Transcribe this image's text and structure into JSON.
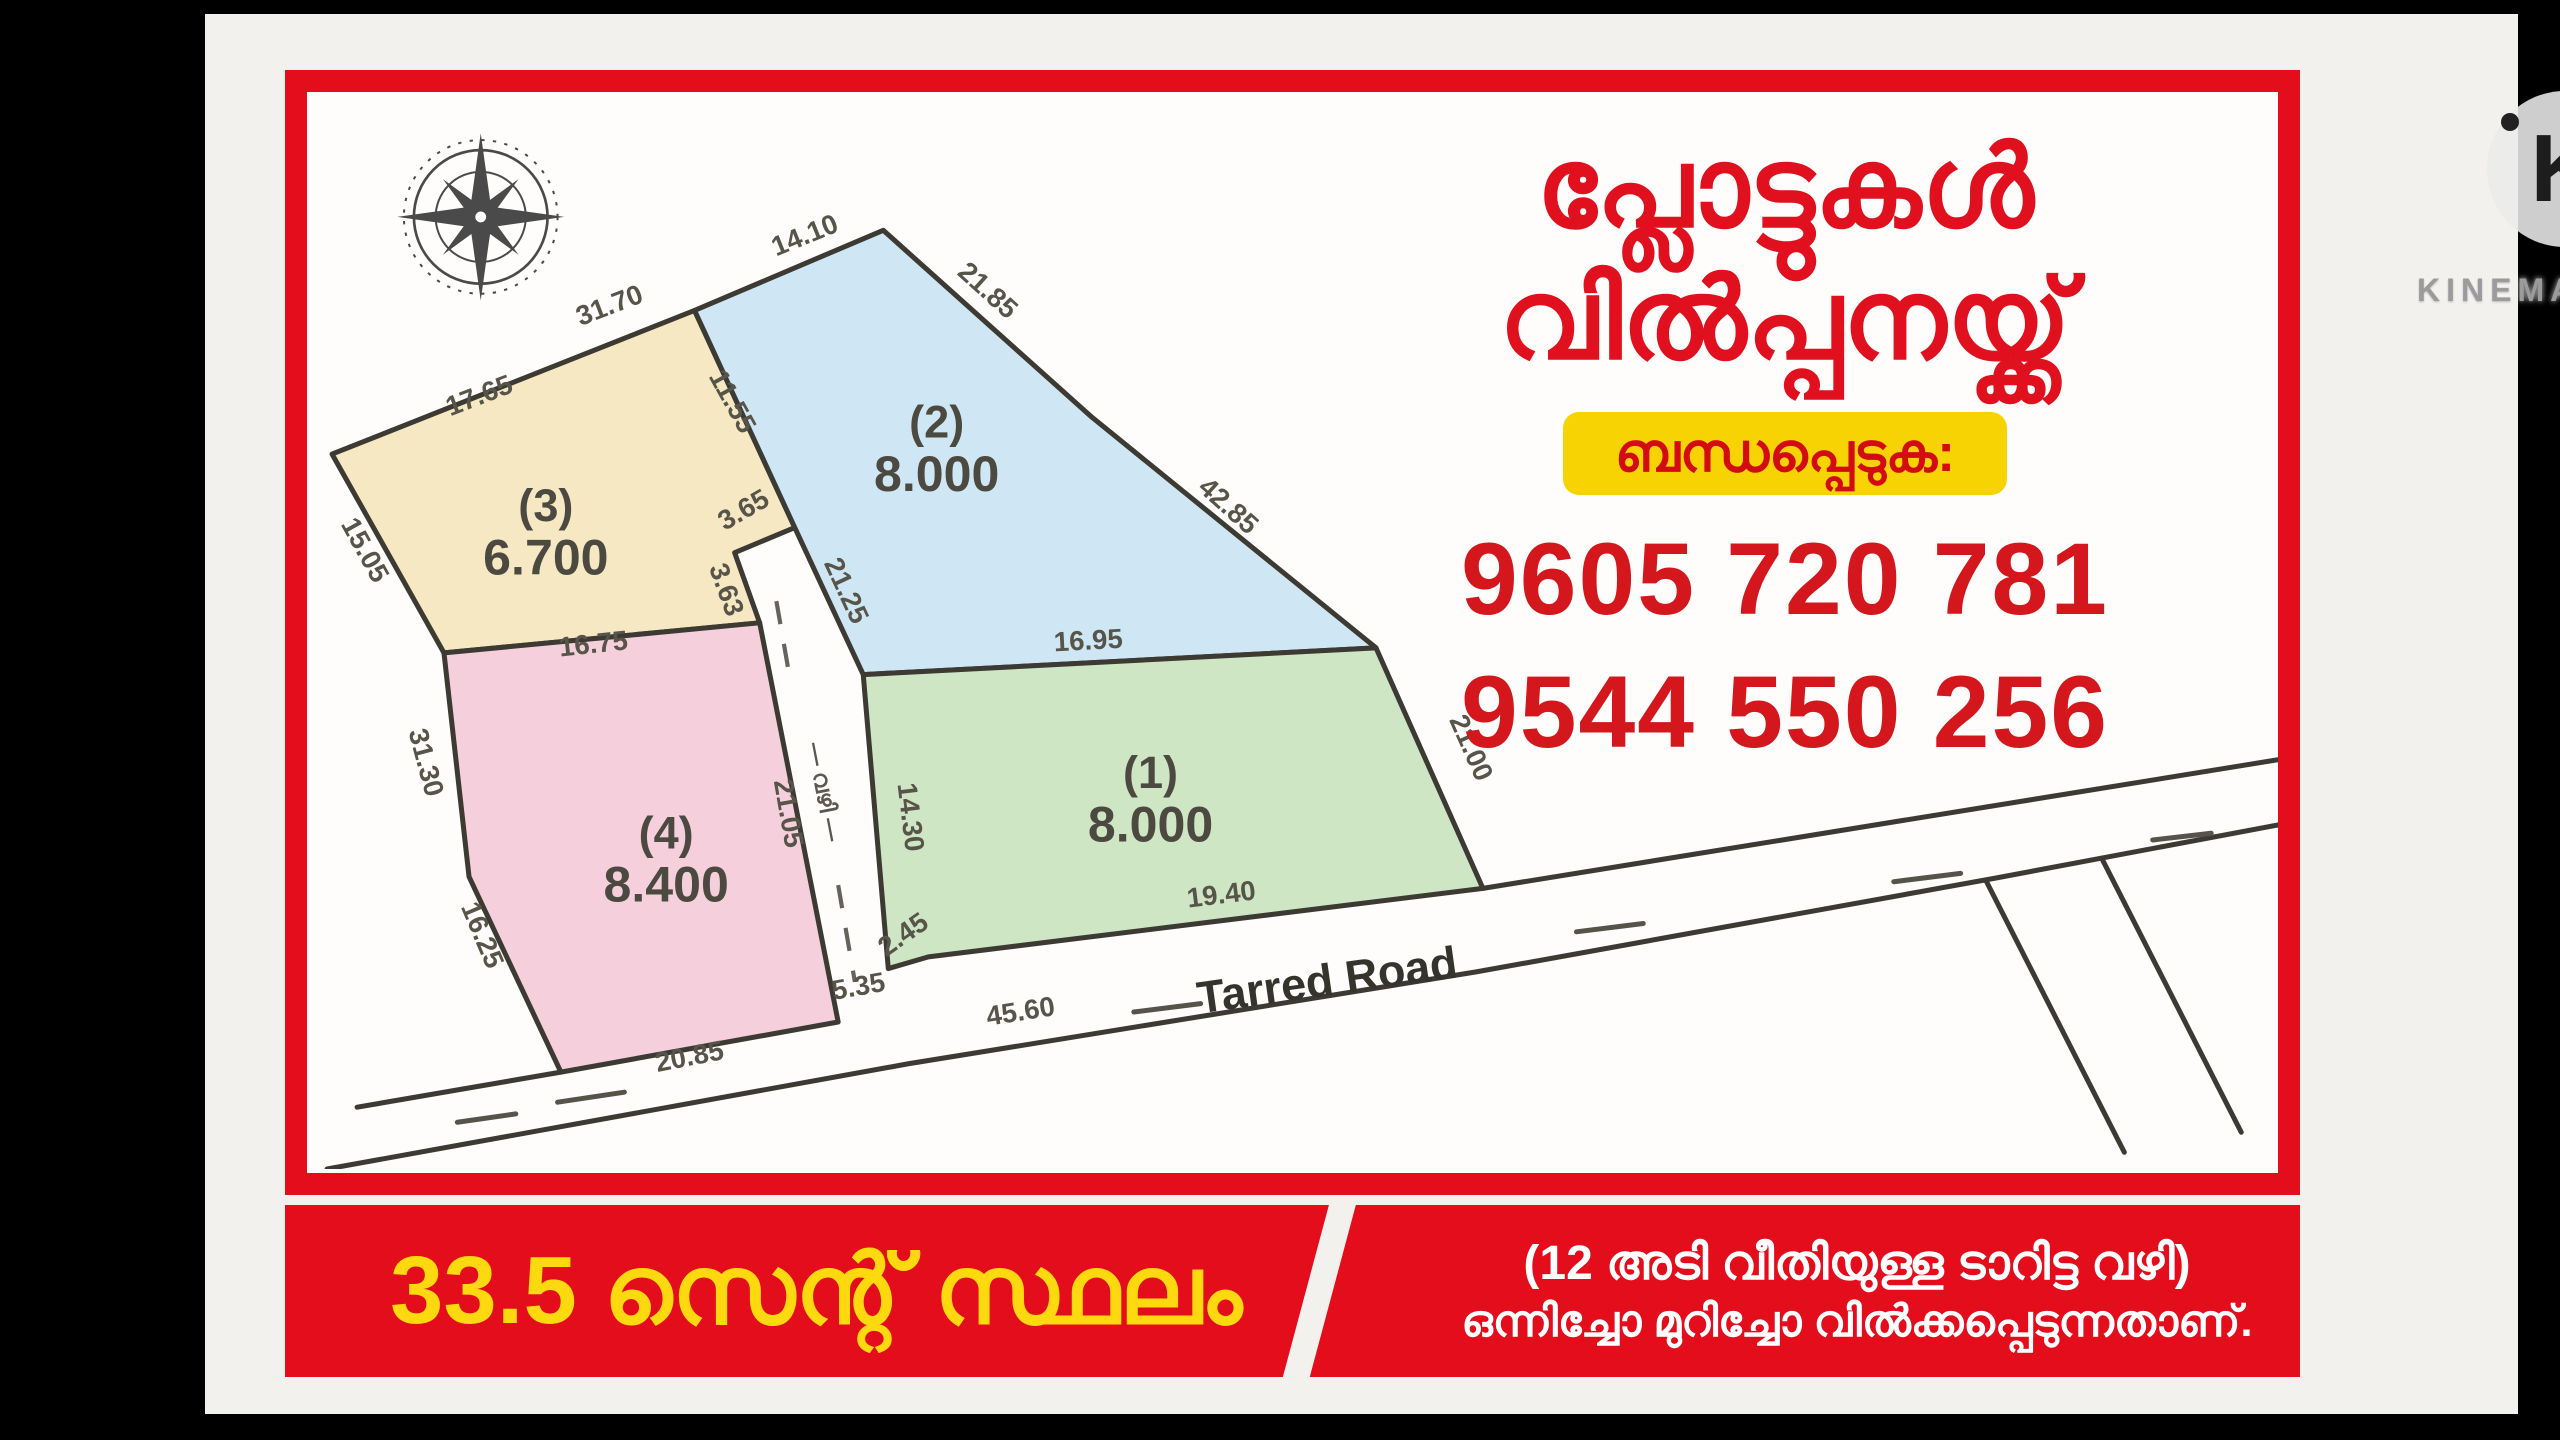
{
  "watermark": {
    "logo_letter": "K",
    "brand": "KINEMASTER"
  },
  "poster": {
    "title_line1": "പ്ലോട്ടുകൾ",
    "title_line2": "വിൽപ്പനയ്ക്ക്",
    "contact_label": "ബന്ധപ്പെടുക:",
    "phone1": "9605 720 781",
    "phone2": "9544 550 256",
    "banner": {
      "area_text": "33.5 സെന്റ് സ്ഥലം",
      "note_line1": "(12 അടി വീതിയുള്ള ടാറിട്ട വഴി)",
      "note_line2": "ഒന്നിച്ചോ മുറിച്ചോ വിൽക്കപ്പെടുന്നതാണ്."
    }
  },
  "diagram": {
    "road_label": "Tarred Road",
    "lane_label": "— വഴി —",
    "plots": [
      {
        "no": "(1)",
        "area": "8.000",
        "color": "#cfe6c4"
      },
      {
        "no": "(2)",
        "area": "8.000",
        "color": "#cfe7f4"
      },
      {
        "no": "(3)",
        "area": "6.700",
        "color": "#f6e8c3"
      },
      {
        "no": "(4)",
        "area": "8.400",
        "color": "#f6cfdd"
      }
    ],
    "measurements": {
      "top_left": "17.65",
      "top_right": "31.70",
      "p2_top": "14.10",
      "p3_right": "11.55",
      "p2_left": "21.25",
      "lane_mouth": "3.65",
      "lane_jog": "3.63",
      "p3_left": "15.05",
      "p2_right_upper": "21.85",
      "p2_right_lower": "42.85",
      "p1_top": "16.95",
      "p1_right": "21.00",
      "p1_bottom": "19.40",
      "p1_bottom_jog": "2.45",
      "road_left": "5.35",
      "road_frontage": "45.60",
      "p34_boundary": "16.75",
      "lane_left": "21.05",
      "lane_right": "14.30",
      "p4_left_upper": "31.30",
      "p4_left_lower": "16.25",
      "p4_bottom": "20.85"
    }
  },
  "colors": {
    "poster_red": "#e30d1c",
    "title_red": "#e0101e",
    "pill_yellow": "#f7d303",
    "banner_yellow": "#ffd90f"
  }
}
